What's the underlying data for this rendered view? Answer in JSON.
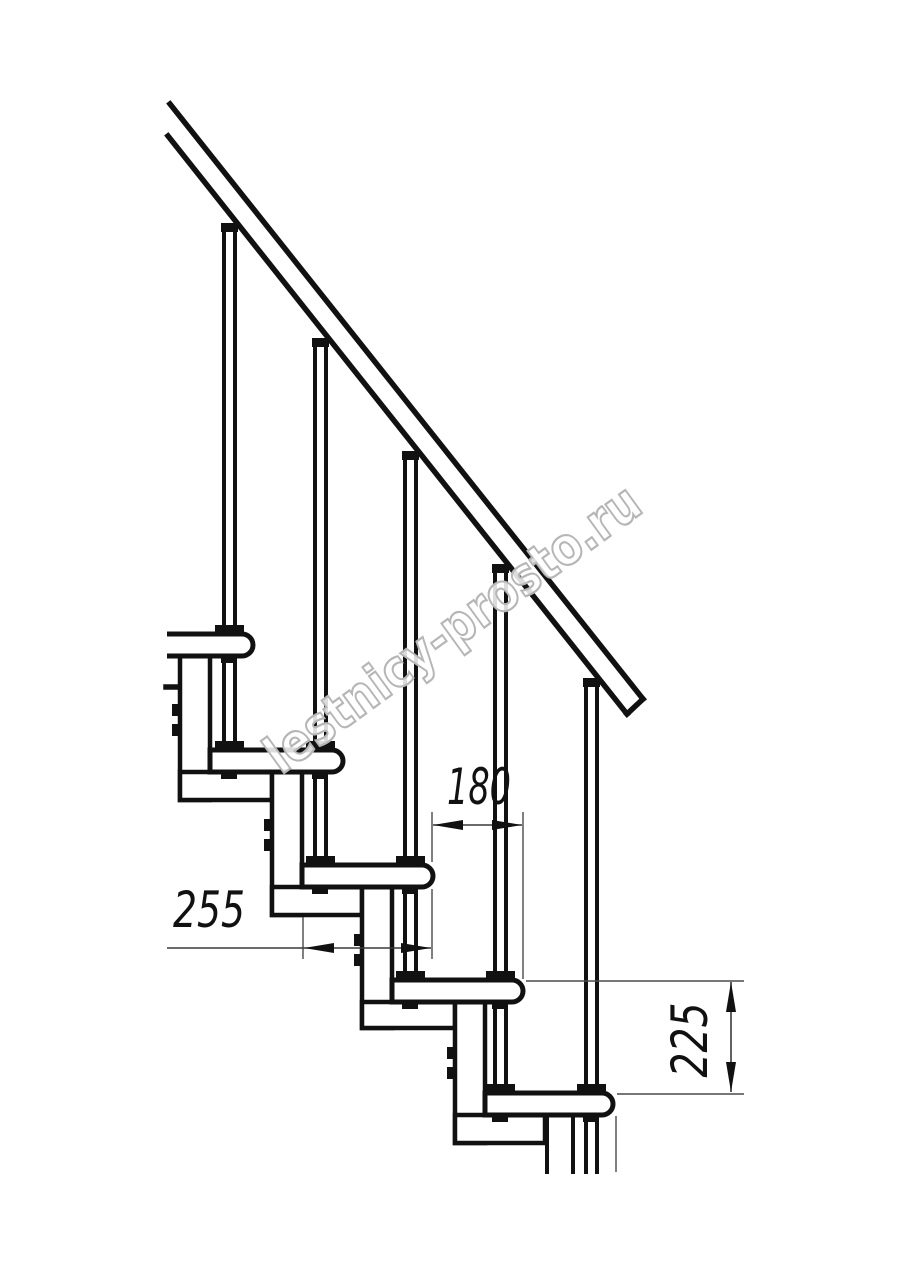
{
  "drawing": {
    "type": "modular staircase side elevation",
    "treads_visible": 5,
    "balusters_visible": 5,
    "line_color": "#111111",
    "background": "#ffffff"
  },
  "dimensions": {
    "run": {
      "value": "180",
      "orientation": "horizontal"
    },
    "depth": {
      "value": "255",
      "orientation": "horizontal"
    },
    "rise": {
      "value": "225",
      "orientation": "vertical"
    }
  },
  "watermark": {
    "text": "lestnicy-prosto.ru",
    "color": "#b6b6b6"
  }
}
